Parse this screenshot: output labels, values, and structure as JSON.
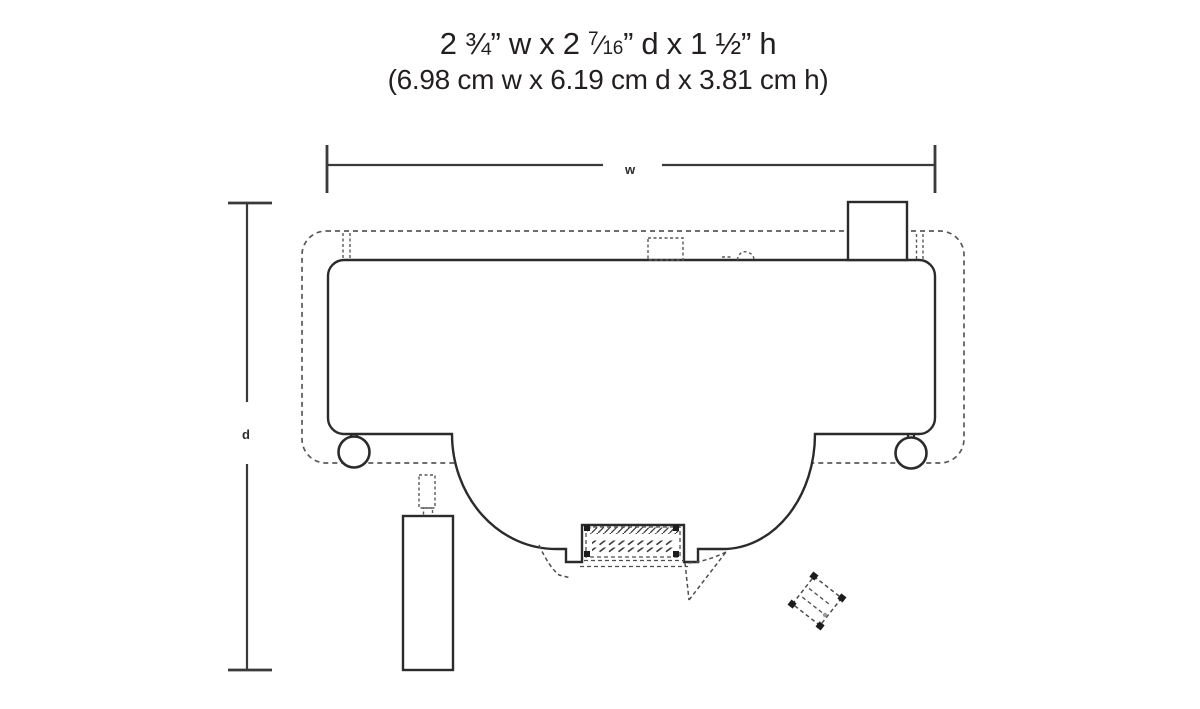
{
  "header": {
    "line1_before": "2 ¾” w x 2 ",
    "fraction_numerator": "7",
    "fraction_slash": "⁄",
    "fraction_denominator": "16",
    "line1_after": "” d x 1 ½” h",
    "line2": "(6.98 cm w x 6.19 cm d x 3.81 cm h)"
  },
  "dimensions": {
    "width_label": "w",
    "depth_label": "d"
  },
  "colors": {
    "solid_line": "#2b2b2b",
    "dashed_line": "#58595b",
    "background": "#ffffff"
  }
}
